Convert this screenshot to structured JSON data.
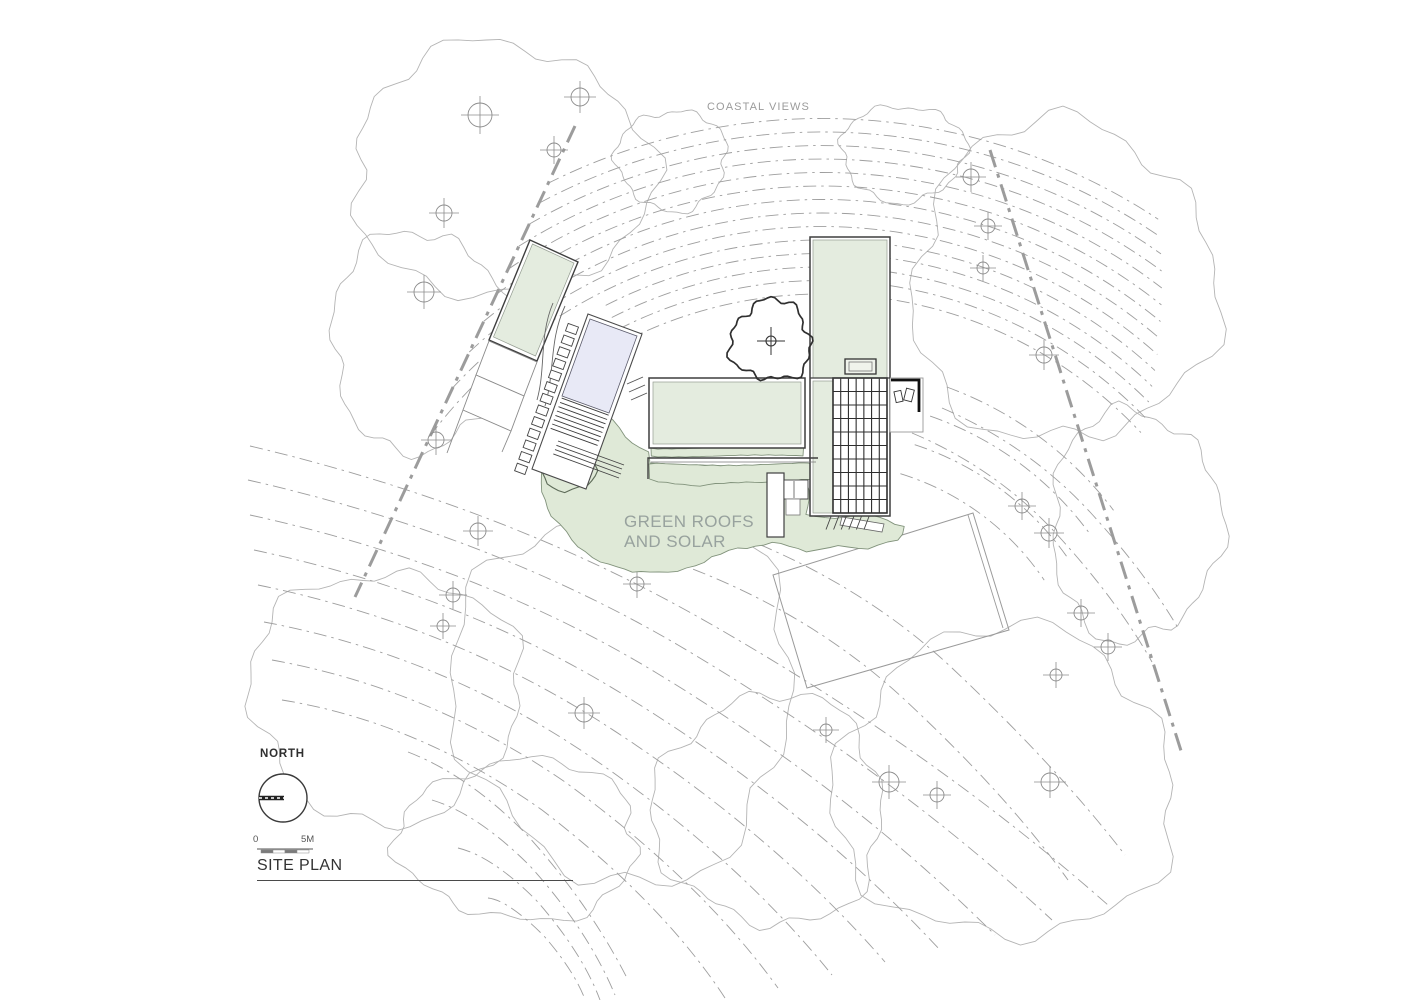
{
  "labels": {
    "coastal_views": "COASTAL VIEWS",
    "green_roofs_line1": "GREEN ROOFS",
    "green_roofs_line2": "AND SOLAR",
    "north": "NORTH",
    "scale_zero": "0",
    "scale_five": "5M",
    "title": "SITE PLAN"
  },
  "colors": {
    "paper": "#ffffff",
    "canopy": "#b4b4b4",
    "contour": "#9e9e9e",
    "boundary": "#9c9c9c",
    "marker": "#8c8c8c",
    "building_stroke": "#3f3f3f",
    "inner_stroke": "#949c91",
    "roof_green": "#e4ecdf",
    "veg_fill": "#dfe9d7",
    "veg_stroke": "#82937c",
    "pool_blue": "#e8e9f6",
    "dark": "#262626"
  },
  "drawing": {
    "canvas": {
      "w": 1414,
      "h": 1000
    },
    "canopies": [
      {
        "c": [
          500,
          170
        ],
        "rx": 150,
        "ry": 125,
        "seed": 1
      },
      {
        "c": [
          420,
          340
        ],
        "rx": 90,
        "ry": 110,
        "seed": 2
      },
      {
        "c": [
          672,
          160
        ],
        "rx": 55,
        "ry": 50,
        "seed": 10
      },
      {
        "c": [
          903,
          153
        ],
        "rx": 62,
        "ry": 48,
        "seed": 9
      },
      {
        "c": [
          1063,
          283
        ],
        "rx": 152,
        "ry": 160,
        "seed": 7
      },
      {
        "c": [
          1135,
          525
        ],
        "rx": 85,
        "ry": 115,
        "seed": 8
      },
      {
        "c": [
          385,
          695
        ],
        "rx": 135,
        "ry": 125,
        "seed": 3
      },
      {
        "c": [
          520,
          840
        ],
        "rx": 120,
        "ry": 80,
        "seed": 11
      },
      {
        "c": [
          625,
          690
        ],
        "rx": 170,
        "ry": 190,
        "seed": 4
      },
      {
        "c": [
          770,
          810
        ],
        "rx": 115,
        "ry": 115,
        "seed": 5
      },
      {
        "c": [
          1005,
          785
        ],
        "rx": 170,
        "ry": 155,
        "seed": 6
      }
    ],
    "upper_band": {
      "center": [
        822,
        730
      ],
      "r_min": 436,
      "r_step": 13.5,
      "count": 14,
      "theta_end_base": -43,
      "theta_end_step": -1.05,
      "theta_fallback": -117,
      "boundary_clip": [
        [
          575,
          126
        ],
        [
          355,
          597
        ]
      ]
    },
    "inner_arcs": [
      {
        "r": 268,
        "a0": -73,
        "a1": -34
      },
      {
        "r": 300,
        "a0": -72,
        "a1": -35
      },
      {
        "r": 332,
        "a0": -71,
        "a1": -36
      },
      {
        "r": 365,
        "a0": -70,
        "a1": -37
      }
    ],
    "contours_lower": [
      "M 250,446 Q 500,505 700,618 Q 930,748 1108,905",
      "M 248,480 Q 490,535 678,645 Q 890,770 1052,920",
      "M 250,515 Q 478,565 655,672 Q 850,790 995,935",
      "M 254,550 Q 465,595 632,700 Q 812,812 940,950",
      "M 258,585 Q 452,625 610,728 Q 775,835 885,962",
      "M 264,622 Q 440,655 588,755 Q 738,858 832,975",
      "M 272,660 Q 428,688 565,782 Q 700,880 778,988",
      "M 282,700 Q 418,722 542,810 Q 662,902 725,998",
      "M 408,752 Q 470,776 528,836 Q 590,905 628,980",
      "M 432,800 Q 478,814 530,866 Q 588,930 615,995",
      "M 458,848 Q 492,856 536,900 Q 582,952 600,1000",
      "M 488,898 Q 508,900 544,936 Q 578,975 588,1008",
      "M 688,518 Q 845,568 952,668 Q 1058,768 1125,855",
      "M 645,552 Q 800,602 905,700 Q 1008,796 1068,880",
      "M 912,433 Q 1000,470 1062,540 Q 1118,602 1152,662",
      "M 942,408 Q 1028,445 1090,512 Q 1145,572 1178,628"
    ],
    "boundaries": [
      [
        575,
        126,
        355,
        597
      ],
      [
        990,
        150,
        1183,
        757
      ]
    ],
    "markers": [
      [
        480,
        115,
        12
      ],
      [
        580,
        97,
        9
      ],
      [
        554,
        150,
        7
      ],
      [
        444,
        213,
        8
      ],
      [
        424,
        292,
        10
      ],
      [
        436,
        440,
        8
      ],
      [
        478,
        531,
        8
      ],
      [
        453,
        595,
        7
      ],
      [
        443,
        626,
        6
      ],
      [
        637,
        584,
        7
      ],
      [
        584,
        713,
        9
      ],
      [
        826,
        730,
        6
      ],
      [
        889,
        782,
        10
      ],
      [
        937,
        795,
        7
      ],
      [
        1050,
        782,
        9
      ],
      [
        971,
        177,
        8
      ],
      [
        988,
        226,
        7
      ],
      [
        983,
        268,
        6
      ],
      [
        1044,
        355,
        8
      ],
      [
        1022,
        506,
        7
      ],
      [
        1049,
        533,
        8
      ],
      [
        1081,
        613,
        7
      ],
      [
        1108,
        647,
        7
      ],
      [
        1056,
        675,
        6
      ]
    ],
    "terrace": {
      "outline": [
        [
          773,
          575
        ],
        [
          973,
          513
        ],
        [
          1009,
          630
        ],
        [
          807,
          688
        ]
      ],
      "inner_line": [
        968,
        515,
        1003,
        628
      ]
    },
    "vegetation": [
      {
        "amp": 2.2,
        "step": 9,
        "seed": 3,
        "pts": [
          [
            548,
            446
          ],
          [
            564,
            420
          ],
          [
            586,
            428
          ],
          [
            604,
            414
          ],
          [
            626,
            436
          ],
          [
            648,
            452
          ],
          [
            650,
            463
          ],
          [
            700,
            464
          ],
          [
            750,
            468
          ],
          [
            806,
            465
          ],
          [
            808,
            490
          ],
          [
            806,
            514
          ],
          [
            835,
            518
          ],
          [
            862,
            515
          ],
          [
            888,
            519
          ],
          [
            903,
            526
          ],
          [
            898,
            541
          ],
          [
            868,
            549
          ],
          [
            838,
            545
          ],
          [
            806,
            553
          ],
          [
            772,
            541
          ],
          [
            738,
            549
          ],
          [
            704,
            562
          ],
          [
            668,
            572
          ],
          [
            632,
            573
          ],
          [
            601,
            561
          ],
          [
            571,
            541
          ],
          [
            552,
            516
          ],
          [
            541,
            483
          ],
          [
            540,
            461
          ]
        ]
      },
      {
        "amp": 1.2,
        "step": 7,
        "seed": 5,
        "pts": [
          [
            651,
            448
          ],
          [
            803,
            448
          ],
          [
            803,
            456
          ],
          [
            651,
            456
          ]
        ]
      },
      {
        "amp": 1.8,
        "step": 8,
        "seed": 7,
        "pts": [
          [
            649,
            464
          ],
          [
            816,
            464
          ],
          [
            817,
            477
          ],
          [
            754,
            483
          ],
          [
            700,
            486
          ],
          [
            650,
            479
          ]
        ]
      },
      {
        "amp": 1.6,
        "step": 7,
        "seed": 9,
        "stroke": "#5d6b58",
        "sw": 1.1,
        "pts": [
          [
            549,
            451
          ],
          [
            572,
            445
          ],
          [
            591,
            453
          ],
          [
            597,
            470
          ],
          [
            588,
            486
          ],
          [
            565,
            492
          ],
          [
            547,
            484
          ],
          [
            539,
            467
          ]
        ]
      }
    ],
    "polys": [
      {
        "pts": [
          [
            530,
            240
          ],
          [
            578,
            262
          ],
          [
            537,
            361
          ],
          [
            489,
            340
          ]
        ],
        "fill": "#ffffff",
        "stroke": "#3f3f3f",
        "sw": 1.4
      },
      {
        "pts": [
          [
            532.5,
            244
          ],
          [
            574,
            263
          ],
          [
            535.5,
            356
          ],
          [
            493.5,
            337
          ]
        ],
        "fill": "#e4ecdf",
        "stroke": "#949c91",
        "sw": 0.7
      },
      {
        "pts": [
          [
            489,
            341
          ],
          [
            537,
            362
          ],
          [
            524,
            396
          ],
          [
            476,
            375
          ]
        ],
        "fill": "#ffffff",
        "stroke": "#8a8a8a",
        "sw": 0.9
      },
      {
        "pts": [
          [
            476,
            375
          ],
          [
            524,
            396
          ],
          [
            511,
            431
          ],
          [
            463,
            410
          ]
        ],
        "fill": "#ffffff",
        "stroke": "#8a8a8a",
        "sw": 0.9
      },
      {
        "pts": [
          [
            588,
            314
          ],
          [
            642,
            334
          ],
          [
            586,
            489
          ],
          [
            532,
            469
          ]
        ],
        "fill": "#ffffff",
        "stroke": "#4a4a4a",
        "sw": 1.1
      },
      {
        "pts": [
          [
            590,
            319
          ],
          [
            637,
            336
          ],
          [
            609,
            413
          ],
          [
            562,
            396
          ]
        ],
        "fill": "#e8e9f6",
        "stroke": "#5a5a6a",
        "sw": 0.8
      },
      {
        "pts": [
          [
            842,
            517
          ],
          [
            884,
            524
          ],
          [
            882,
            532
          ],
          [
            840,
            525
          ]
        ],
        "fill": "#ffffff",
        "stroke": "#666666",
        "sw": 0.8
      }
    ],
    "rects": [
      {
        "x": 649,
        "y": 378,
        "w": 156,
        "h": 70,
        "fill": "#ffffff",
        "stroke": "#3f3f3f",
        "sw": 1.5
      },
      {
        "x": 653,
        "y": 382,
        "w": 148,
        "h": 62,
        "fill": "#e4ecdf",
        "stroke": "#949c91",
        "sw": 0.7
      },
      {
        "x": 810,
        "y": 237,
        "w": 80,
        "h": 279,
        "fill": "#ffffff",
        "stroke": "#3f3f3f",
        "sw": 1.5
      },
      {
        "x": 813,
        "y": 240,
        "w": 74,
        "h": 138,
        "fill": "#e4ecdf",
        "stroke": "#949c91",
        "sw": 0.7
      },
      {
        "x": 813,
        "y": 381,
        "w": 20,
        "h": 132,
        "fill": "#e4ecdf",
        "stroke": "#949c91",
        "sw": 0.7
      },
      {
        "x": 833,
        "y": 378,
        "w": 54,
        "h": 135,
        "fill": "#ffffff",
        "stroke": "#2e2e2e",
        "sw": 1.6
      },
      {
        "x": 845,
        "y": 359,
        "w": 31,
        "h": 15,
        "fill": "#f0f4ec",
        "stroke": "#333333",
        "sw": 1.3
      },
      {
        "x": 849,
        "y": 362,
        "w": 23,
        "h": 9,
        "fill": "none",
        "stroke": "#777777",
        "sw": 0.8
      },
      {
        "x": 890,
        "y": 378,
        "w": 33,
        "h": 54,
        "fill": "#ffffff",
        "stroke": "#9a9a9a",
        "sw": 0.9
      },
      {
        "x": 767,
        "y": 473,
        "w": 17,
        "h": 64,
        "fill": "#ffffff",
        "stroke": "#3f3f3f",
        "sw": 1.2
      },
      {
        "x": 784,
        "y": 480,
        "w": 24,
        "h": 19,
        "fill": "#ffffff",
        "stroke": "#3f3f3f",
        "sw": 0.9
      },
      {
        "x": 786,
        "y": 499,
        "w": 14,
        "h": 16,
        "fill": "#ffffff",
        "stroke": "#777777",
        "sw": 0.8
      }
    ],
    "solar_grid": {
      "x": 833,
      "y": 378,
      "w": 54,
      "h": 135,
      "cols": 7,
      "rows": 10,
      "stroke": "#2e2e2e",
      "sw": 1.1
    },
    "furniture": [
      {
        "x": 895,
        "y": 391,
        "w": 7,
        "h": 11,
        "rot": -12
      },
      {
        "x": 905,
        "y": 389,
        "w": 8,
        "h": 12,
        "rot": 14
      }
    ],
    "paths": [
      {
        "d": "M 648,479 L 648,458 L 818,458",
        "stroke": "#3f3f3f",
        "sw": 1.4
      },
      {
        "d": "M 651,462 L 816,462",
        "stroke": "#777777",
        "sw": 0.8
      },
      {
        "d": "M 891,380 L 919,380 L 919,412",
        "stroke": "#111111",
        "sw": 2.8
      },
      {
        "d": "M 794,481 L 794,498",
        "stroke": "#555555",
        "sw": 0.8
      },
      {
        "d": "M 810,378 L 890,378",
        "stroke": "#3f3f3f",
        "sw": 1.2
      },
      {
        "d": "M 553,303 C 539,336 546,368 537,400",
        "stroke": "#666666",
        "sw": 0.9
      },
      {
        "d": "M 565,306 C 549,340 555,372 545,406",
        "stroke": "#666666",
        "sw": 0.9
      },
      {
        "d": "M 463,410 L 447,453",
        "stroke": "#8a8a8a",
        "sw": 0.9
      },
      {
        "d": "M 511,431 L 502,452",
        "stroke": "#8a8a8a",
        "sw": 0.9
      },
      {
        "d": "M 627,384 L 643,377",
        "stroke": "#555555",
        "sw": 0.9
      },
      {
        "d": "M 629,392 L 645,385",
        "stroke": "#555555",
        "sw": 0.9
      },
      {
        "d": "M 631,400 L 647,393",
        "stroke": "#555555",
        "sw": 0.9
      },
      {
        "d": "M 558,441 L 624,465",
        "stroke": "#444444",
        "sw": 0.9
      },
      {
        "d": "M 556.4,445.3 L 622,469",
        "stroke": "#444444",
        "sw": 0.9
      },
      {
        "d": "M 555,449.6 L 621,474",
        "stroke": "#444444",
        "sw": 0.9
      },
      {
        "d": "M 553.3,453.9 L 619,478",
        "stroke": "#444444",
        "sw": 0.9
      }
    ],
    "solar_steps": {
      "x0": 831,
      "y0": 516.5,
      "dx": 7.6,
      "slant_x": -5,
      "slant_y": 13,
      "count": 6
    },
    "pool_steps": {
      "A": [
        588,
        314
      ],
      "angle": 20,
      "x0": 4,
      "x1": 54,
      "y_start": 88,
      "gap": 4.6,
      "count": 8
    },
    "stones": {
      "start": [
        572,
        329
      ],
      "angle": 20,
      "count": 13,
      "gap": 12.4,
      "w": 11,
      "h": 8
    },
    "tree": {
      "c": [
        771,
        341
      ],
      "r": 40,
      "seed": 12
    },
    "north_arrow": {
      "c": [
        283,
        798
      ],
      "r": 24
    },
    "scale_bar": {
      "x": 257,
      "y": 849,
      "len": 56,
      "seg": 12,
      "segs": 4
    }
  }
}
